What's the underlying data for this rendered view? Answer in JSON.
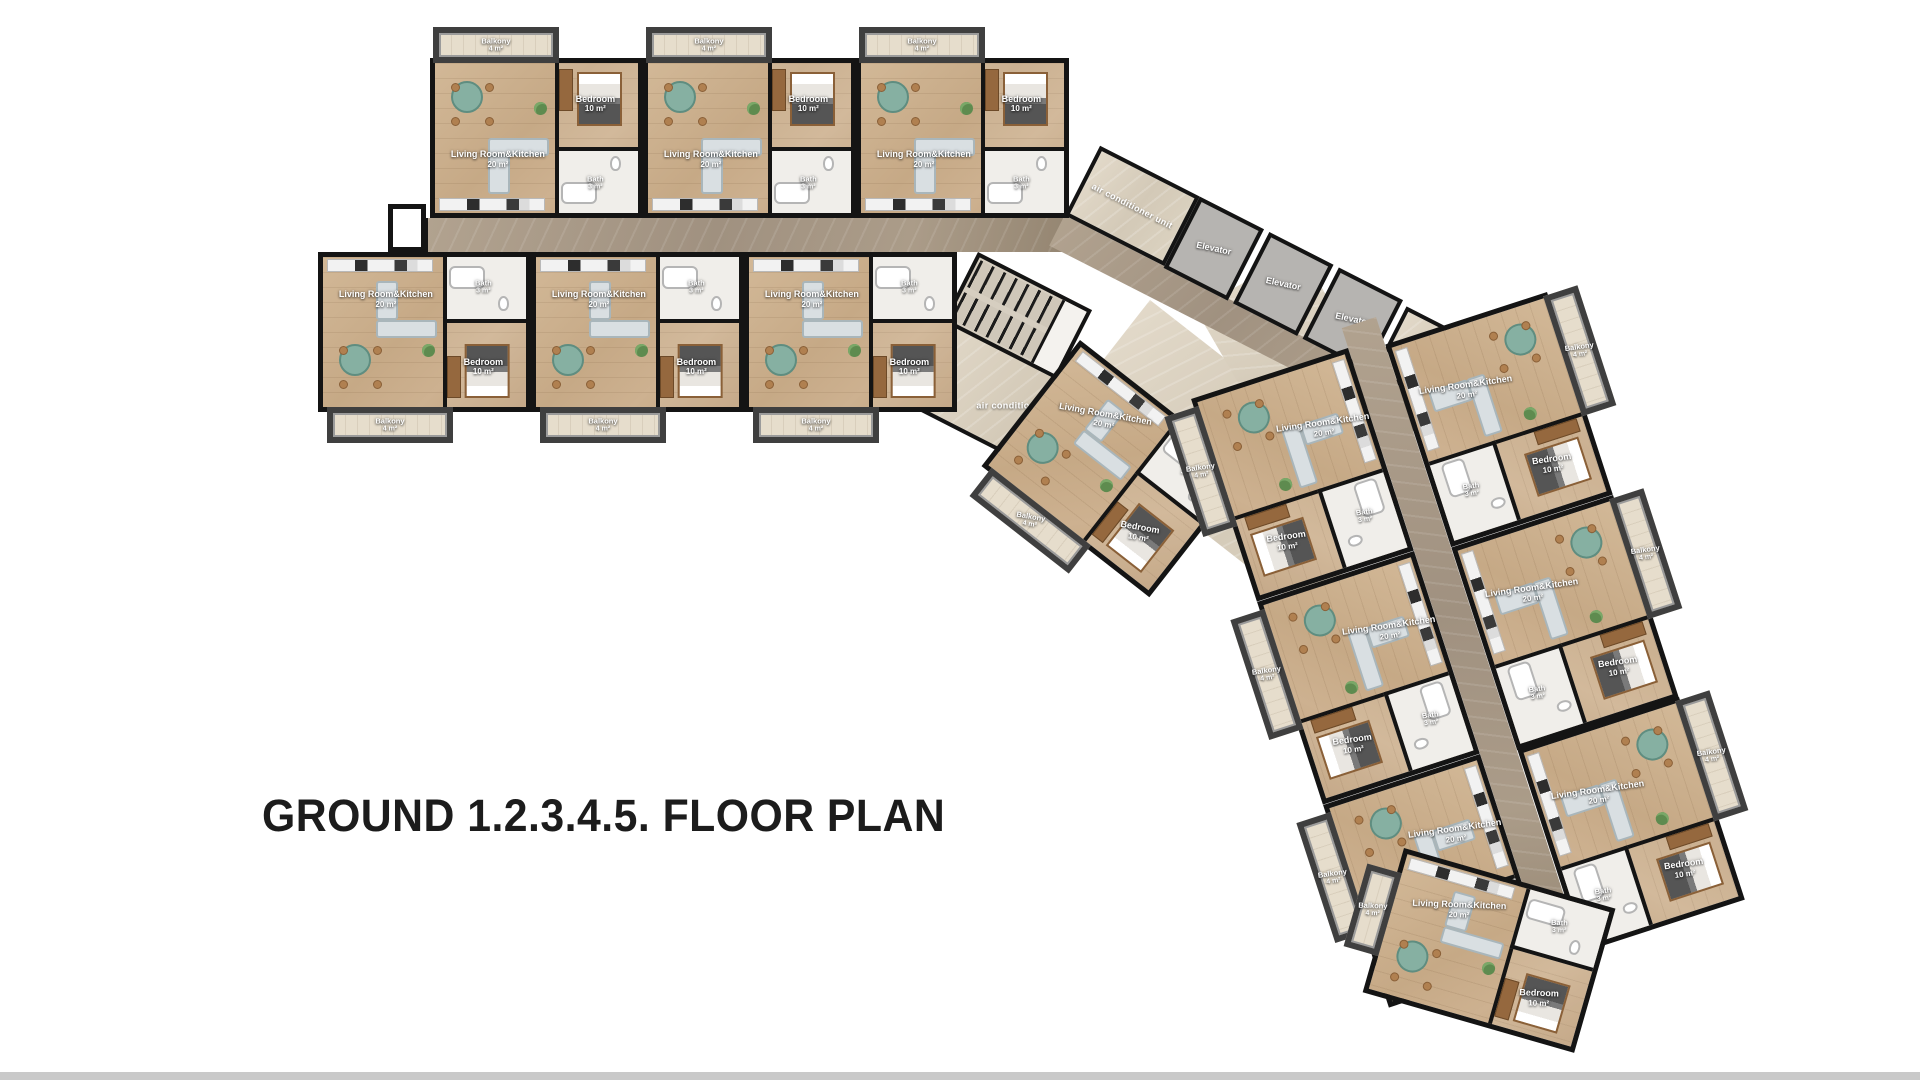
{
  "title": "GROUND 1.2.3.4.5. FLOOR PLAN",
  "labels": {
    "living": "Living Room&Kitchen",
    "living_area": "20 m²",
    "bedroom": "Bedroom",
    "bedroom_area": "10 m²",
    "bath": "Bath",
    "bath_area": "3 m²",
    "balcony": "Balkony",
    "balcony_area": "4 m²",
    "elevator": "Elevator",
    "ac_unit": "air conditioner unit"
  },
  "elevators": [
    {
      "label": "Elevator"
    },
    {
      "label": "Elevator"
    },
    {
      "label": "Elevator"
    }
  ],
  "ac_areas": [
    {
      "label": "air conditioner unit"
    },
    {
      "label": "air conditioner unit"
    },
    {
      "label": "air conditioner unit"
    }
  ],
  "units": [
    {
      "id": "top-row-1",
      "living": "Living Room&Kitchen",
      "living_area": "20 m²",
      "bedroom": "Bedroom",
      "bedroom_area": "10 m²",
      "bath": "Bath",
      "bath_area": "3 m²",
      "balcony": "Balkony",
      "balcony_area": "4 m²"
    },
    {
      "id": "top-row-2",
      "living": "Living Room&Kitchen",
      "living_area": "20 m²",
      "bedroom": "Bedroom",
      "bedroom_area": "10 m²",
      "bath": "Bath",
      "bath_area": "3 m²",
      "balcony": "Balkony",
      "balcony_area": "4 m²"
    },
    {
      "id": "top-row-3",
      "living": "Living Room&Kitchen",
      "living_area": "20 m²",
      "bedroom": "Bedroom",
      "bedroom_area": "10 m²",
      "bath": "Bath",
      "bath_area": "3 m²",
      "balcony": "Balkony",
      "balcony_area": "4 m²"
    },
    {
      "id": "bottom-row-1",
      "living": "Living Room&Kitchen",
      "living_area": "20 m²",
      "bedroom": "Bedroom",
      "bedroom_area": "10 m²",
      "bath": "Bath",
      "bath_area": "3 m²",
      "balcony": "Balkony",
      "balcony_area": "4 m²"
    },
    {
      "id": "bottom-row-2",
      "living": "Living Room&Kitchen",
      "living_area": "20 m²",
      "bedroom": "Bedroom",
      "bedroom_area": "10 m²",
      "bath": "Bath",
      "bath_area": "3 m²",
      "balcony": "Balkony",
      "balcony_area": "4 m²"
    },
    {
      "id": "bottom-row-3",
      "living": "Living Room&Kitchen",
      "living_area": "20 m²",
      "bedroom": "Bedroom",
      "bedroom_area": "10 m²",
      "bath": "Bath",
      "bath_area": "3 m²",
      "balcony": "Balkony",
      "balcony_area": "4 m²"
    },
    {
      "id": "mid-diagonal",
      "living": "Living Room&Kitchen",
      "living_area": "20 m²",
      "bedroom": "Bedroom",
      "bedroom_area": "10 m²",
      "bath": "Bath",
      "bath_area": "3 m²",
      "balcony": "Balkony",
      "balcony_area": "4 m²"
    },
    {
      "id": "wing-inner-1",
      "living": "Living Room&Kitchen",
      "living_area": "20 m²",
      "bedroom": "Bedroom",
      "bedroom_area": "10 m²",
      "bath": "Bath",
      "bath_area": "3 m²",
      "balcony": "Balkony",
      "balcony_area": "4 m²"
    },
    {
      "id": "wing-inner-2",
      "living": "Living Room&Kitchen",
      "living_area": "20 m²",
      "bedroom": "Bedroom",
      "bedroom_area": "10 m²",
      "bath": "Bath",
      "bath_area": "3 m²",
      "balcony": "Balkony",
      "balcony_area": "4 m²"
    },
    {
      "id": "wing-inner-3",
      "living": "Living Room&Kitchen",
      "living_area": "20 m²",
      "bedroom": "Bedroom",
      "bedroom_area": "10 m²",
      "bath": "Bath",
      "bath_area": "3 m²",
      "balcony": "Balkony",
      "balcony_area": "4 m²"
    },
    {
      "id": "wing-outer-1",
      "living": "Living Room&Kitchen",
      "living_area": "20 m²",
      "bedroom": "Bedroom",
      "bedroom_area": "10 m²",
      "bath": "Bath",
      "bath_area": "3 m²",
      "balcony": "Balkony",
      "balcony_area": "4 m²"
    },
    {
      "id": "wing-outer-2",
      "living": "Living Room&Kitchen",
      "living_area": "20 m²",
      "bedroom": "Bedroom",
      "bedroom_area": "10 m²",
      "bath": "Bath",
      "bath_area": "3 m²",
      "balcony": "Balkony",
      "balcony_area": "4 m²"
    },
    {
      "id": "wing-outer-3",
      "living": "Living Room&Kitchen",
      "living_area": "20 m²",
      "bedroom": "Bedroom",
      "bedroom_area": "10 m²",
      "bath": "Bath",
      "bath_area": "3 m²",
      "balcony": "Balkony",
      "balcony_area": "4 m²"
    },
    {
      "id": "wing-end",
      "living": "Living Room&Kitchen",
      "living_area": "20 m²",
      "bedroom": "Bedroom",
      "bedroom_area": "10 m²",
      "bath": "Bath",
      "bath_area": "3 m²",
      "balcony": "Balkony",
      "balcony_area": "4 m²"
    }
  ],
  "colors": {
    "wall": "#141414",
    "wood_floor": "#c9ad8e",
    "corridor_marble": "#a79884",
    "hall_marble": "#cfc5b3",
    "balcony_frame": "#3f3f3f",
    "elevator_fill": "#b6b4b1",
    "table_accent": "#86b0a2",
    "title_text": "#1c1c1c",
    "bottom_bar": "#c9c9c9"
  }
}
